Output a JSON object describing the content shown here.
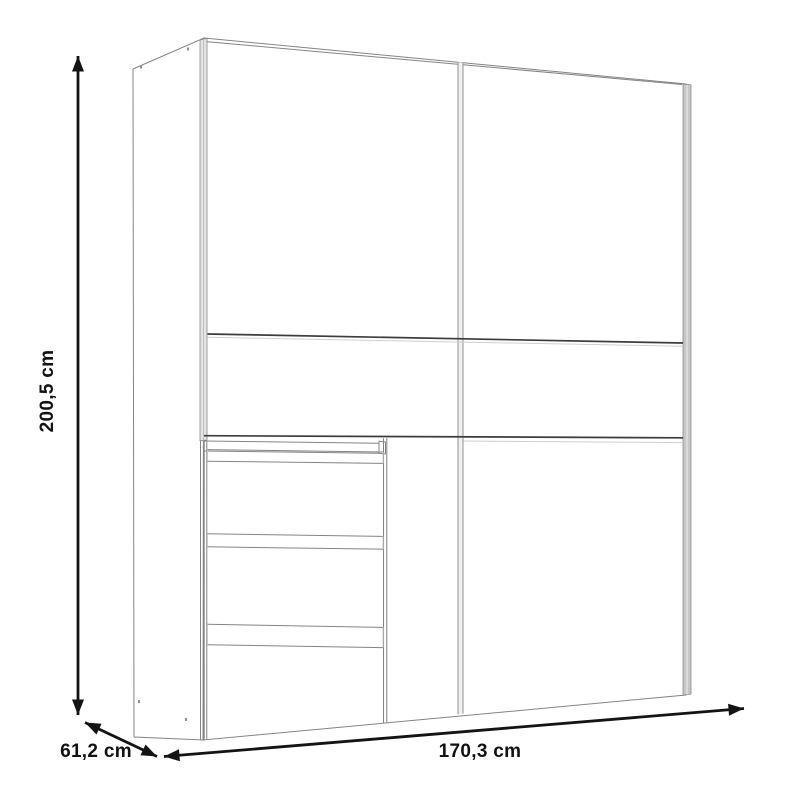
{
  "page": {
    "title": "Wardrobe dimension drawing"
  },
  "diagram": {
    "type": "furniture-dimension-drawing",
    "product": "sliding-door wardrobe with two doors and three drawers",
    "dimensions": {
      "height": {
        "label": "200,5 cm",
        "value_cm": 200.5,
        "orientation": "vertical-left"
      },
      "depth": {
        "label": "61,2 cm",
        "value_cm": 61.2,
        "orientation": "diagonal-bottom-left"
      },
      "width": {
        "label": "170,3 cm",
        "value_cm": 170.3,
        "orientation": "horizontal-bottom"
      }
    },
    "structure": {
      "doors": 2,
      "drawers": 3,
      "door_grooves": 2
    },
    "colors": {
      "background": "#ffffff",
      "outline": "#848484",
      "groove": "#3c3c3c",
      "door_edge_fill": "#c6c6c6",
      "left_edge_fill": "#e4e4e4",
      "divider_fill": "#f0f0f0",
      "dimension": "#141414"
    }
  }
}
